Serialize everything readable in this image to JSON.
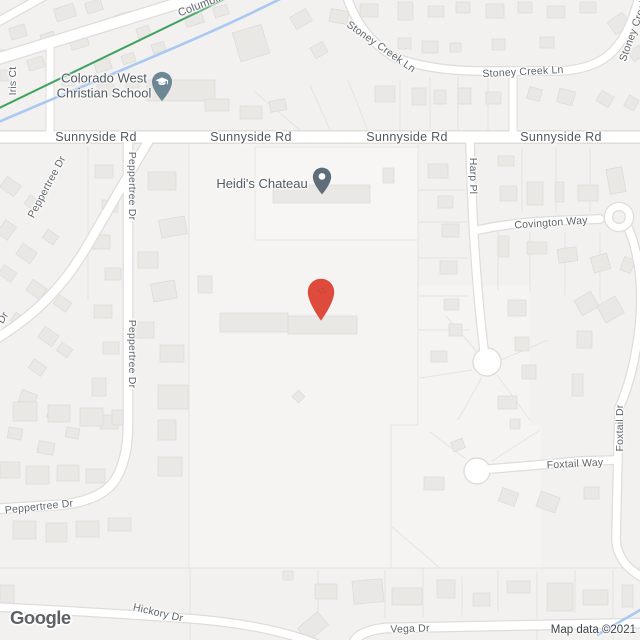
{
  "map": {
    "roads": {
      "sunnyside": {
        "label": "Sunnyside Rd"
      },
      "columbine": {
        "label": "Columbine"
      },
      "stoney_creek": {
        "label": "Stoney Creek Ln",
        "short": "Stoney Creek"
      },
      "iris": {
        "label": "Iris Ct"
      },
      "peppertree": {
        "label": "Peppertree Dr"
      },
      "harp": {
        "label": "Harp Pl"
      },
      "covington": {
        "label": "Covington Way"
      },
      "foxtail_way": {
        "label": "Foxtail Way"
      },
      "foxtail_dr": {
        "label": "Foxtail Dr"
      },
      "hickory": {
        "label": "Hickory Dr"
      },
      "vega": {
        "label": "Vega Dr"
      }
    },
    "pois": {
      "school": {
        "line1": "Colorado West",
        "line2": "Christian School"
      },
      "chateau": {
        "name": "Heidi's Chateau"
      }
    },
    "attribution": {
      "logo": "Google",
      "text": "Map data ©2021"
    },
    "colors": {
      "marker_red": "#de4b3c",
      "school_pin": "#6d8795",
      "place_pin": "#5f6d78",
      "trail_green": "#3fa25f",
      "creek_blue": "#a9c8f2",
      "road_fill": "#ffffff",
      "land": "#f2f1ef"
    }
  }
}
